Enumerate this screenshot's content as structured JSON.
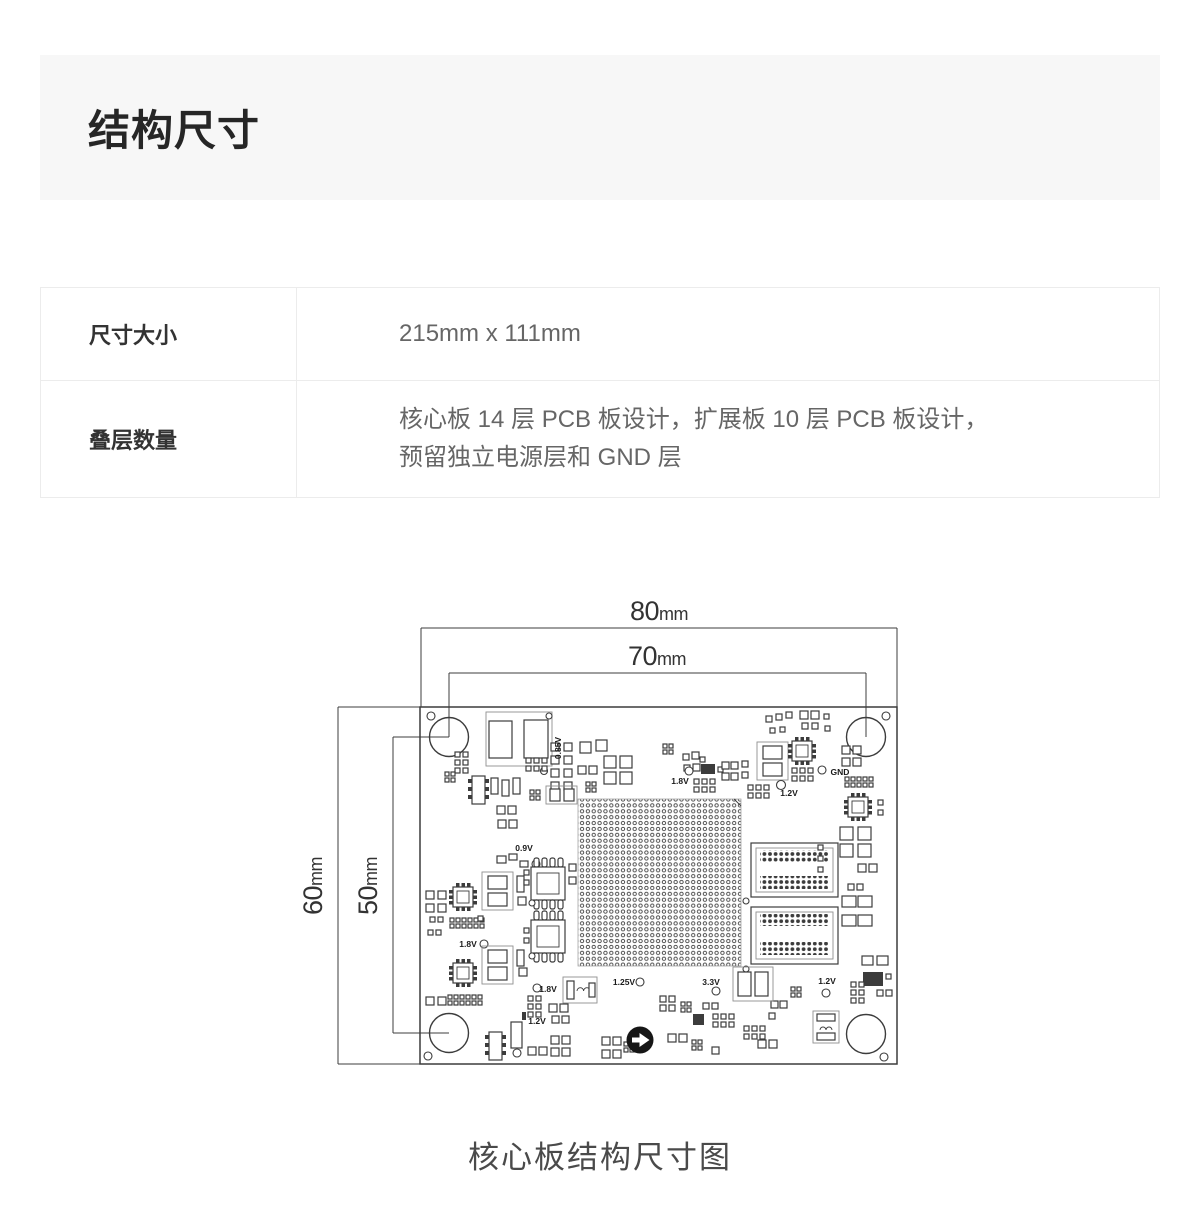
{
  "header": {
    "title": "结构尺寸"
  },
  "table": {
    "rows": [
      {
        "label": "尺寸大小",
        "value_lines": [
          "215mm x 111mm"
        ]
      },
      {
        "label": "叠层数量",
        "value_lines": [
          "核心板 14 层 PCB 板设计，扩展板 10 层 PCB 板设计，",
          "预留独立电源层和 GND 层"
        ]
      }
    ]
  },
  "figure": {
    "caption": "核心板结构尺寸图",
    "dimensions": {
      "width_outer": {
        "value": "80",
        "unit": "mm"
      },
      "width_inner": {
        "value": "70",
        "unit": "mm"
      },
      "height_outer": {
        "value": "60",
        "unit": "mm"
      },
      "height_inner": {
        "value": "50",
        "unit": "mm"
      }
    },
    "pcb_labels": {
      "v085": "0.85V",
      "v09": "0.9V",
      "v18_top": "1.8V",
      "v12_top": "1.2V",
      "gnd": "GND",
      "v18_left": "1.8V",
      "v18_bottom": "1.8V",
      "v12_bottom": "1.2V",
      "v125": "1.25V",
      "v33": "3.3V",
      "v12_right": "1.2V"
    }
  },
  "colors": {
    "header_bg": "#f7f7f7",
    "diagram_line": "#3c3c3c",
    "text_primary": "#333333",
    "text_secondary": "#666666"
  }
}
